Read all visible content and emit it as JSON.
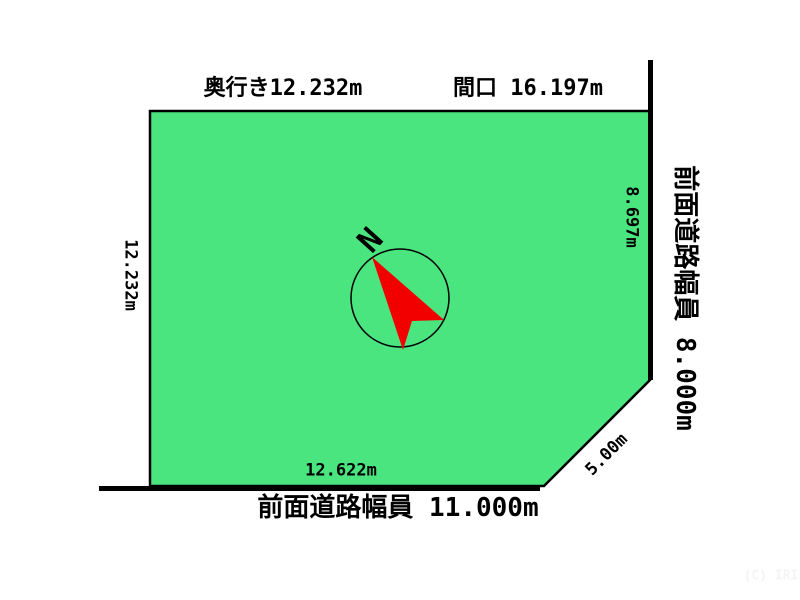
{
  "diagram": {
    "background": "#ffffff",
    "plot": {
      "fill": "#4be57f",
      "outline": "#000000"
    },
    "labels": {
      "top_depth": "奥行き12.232m",
      "top_frontage": "間口 16.197m",
      "left_side": "12.232m",
      "right_inner": "8.697m",
      "right_road": "前面道路幅員 8.000m",
      "bottom_inner": "12.622m",
      "bottom_road": "前面道路幅員 11.000m",
      "corner_cut": "5.00m"
    },
    "compass": {
      "north_label": "N",
      "arrow_color": "#f20000",
      "ring_color": "#000000"
    },
    "watermark": {
      "text": "(C) IRI",
      "color": "#f4f4f4"
    }
  }
}
